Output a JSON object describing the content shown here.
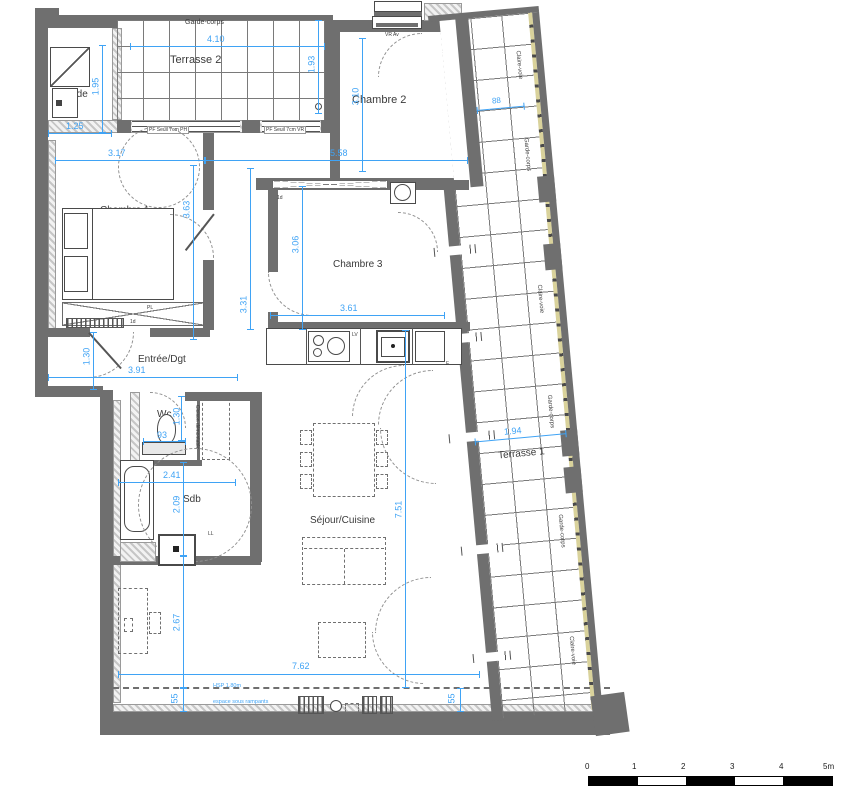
{
  "rooms": {
    "terrasse2": "Terrasse 2",
    "sde": "Sde",
    "chambre2": "Chambre 2",
    "chambre1": "Chambre 1",
    "chambre3": "Chambre 3",
    "entree": "Entrée/Dgt",
    "wc": "Wc",
    "sdb": "Sdb",
    "sejour": "Séjour/Cuisine",
    "terrasse1": "Terrasse 1"
  },
  "railings": {
    "top": "Garde-corps",
    "right": [
      "Claire-voie",
      "Garde-corps",
      "Claire-voie",
      "Garde-corps",
      "Garde-corps",
      "Claire-voie"
    ]
  },
  "dims": {
    "t2_w": "4.10",
    "t2_h": "1.93",
    "sde_h": "1.95",
    "sde_w": "1.25",
    "c2_h": "3.10",
    "c2_w": "5.58",
    "c1_w": "3.17",
    "c1_h": "3.63",
    "c3_h": "3.06",
    "hall_h": "3.31",
    "c3_w": "3.61",
    "ent_w": "3.91",
    "ent_h": "1.30",
    "wc_w": "93",
    "wc_h": "1.30",
    "sdb_w": "2.41",
    "sdb_h": "2.09",
    "sej_h": "7.51",
    "sej_w": "7.62",
    "sej_left": "2.67",
    "ramp_left": "55",
    "ramp_right": "55",
    "t1_w": "1.94",
    "t1_top": "88"
  },
  "windows": {
    "w1": "PF Seuil 7cm PH",
    "w2": "PF Seuil 7cm VR",
    "w3": "VR Av"
  },
  "fixtures": {
    "lv": "LV",
    "f": "F",
    "pl": "PL",
    "ll": "LL",
    "td": "1d",
    "cloison": "Cloison démontable"
  },
  "notes": {
    "hsp": "HSP 1.80m",
    "rampants": "espace sous rampants"
  },
  "scale_bar": {
    "labels": [
      "0",
      "1",
      "2",
      "3",
      "4",
      "5m"
    ]
  },
  "colors": {
    "dimension": "#3fa3f5",
    "wall": "#6f6f6f",
    "claire_voie": "#d9d29b"
  }
}
